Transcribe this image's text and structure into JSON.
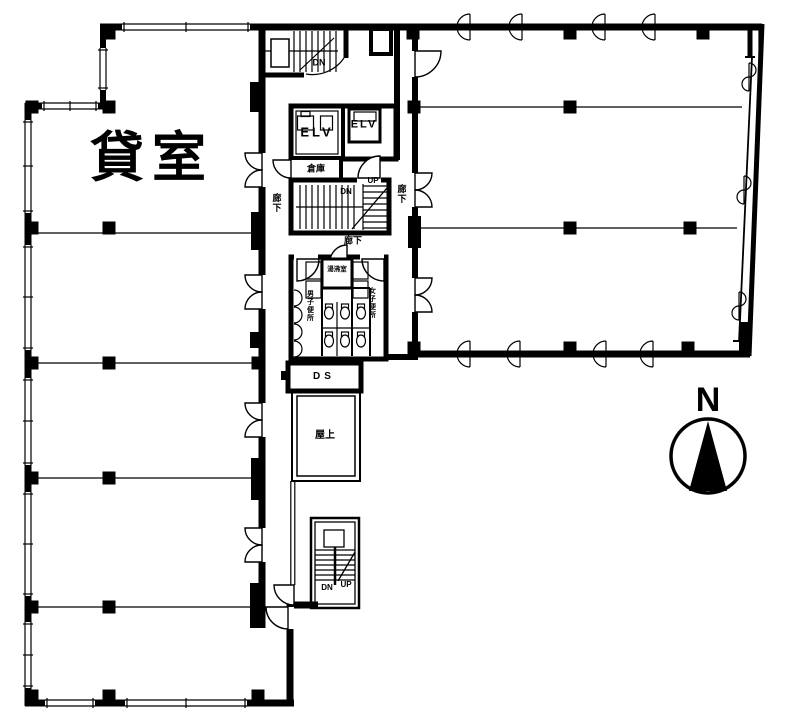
{
  "plan": {
    "background": "#ffffff",
    "line_color": "#000000",
    "labels": {
      "rental_room": "貸室",
      "top_stair_dn": "DN",
      "elevator_left": "ELV",
      "elevator_right": "ELV",
      "storage": "倉庫",
      "corridor_west": "廊下",
      "mid_stair_up": "UP",
      "mid_stair_dn": "DN",
      "corridor_east": "廊下",
      "corridor_center": "廊下",
      "kitchenette": "湯沸室",
      "mens_toilet": "男子便所",
      "womens_toilet": "女子便所",
      "duct_shaft": "DS",
      "rooftop": "屋上",
      "bottom_stair_dn": "DN",
      "bottom_stair_up": "UP"
    },
    "compass": {
      "north": "N"
    }
  }
}
